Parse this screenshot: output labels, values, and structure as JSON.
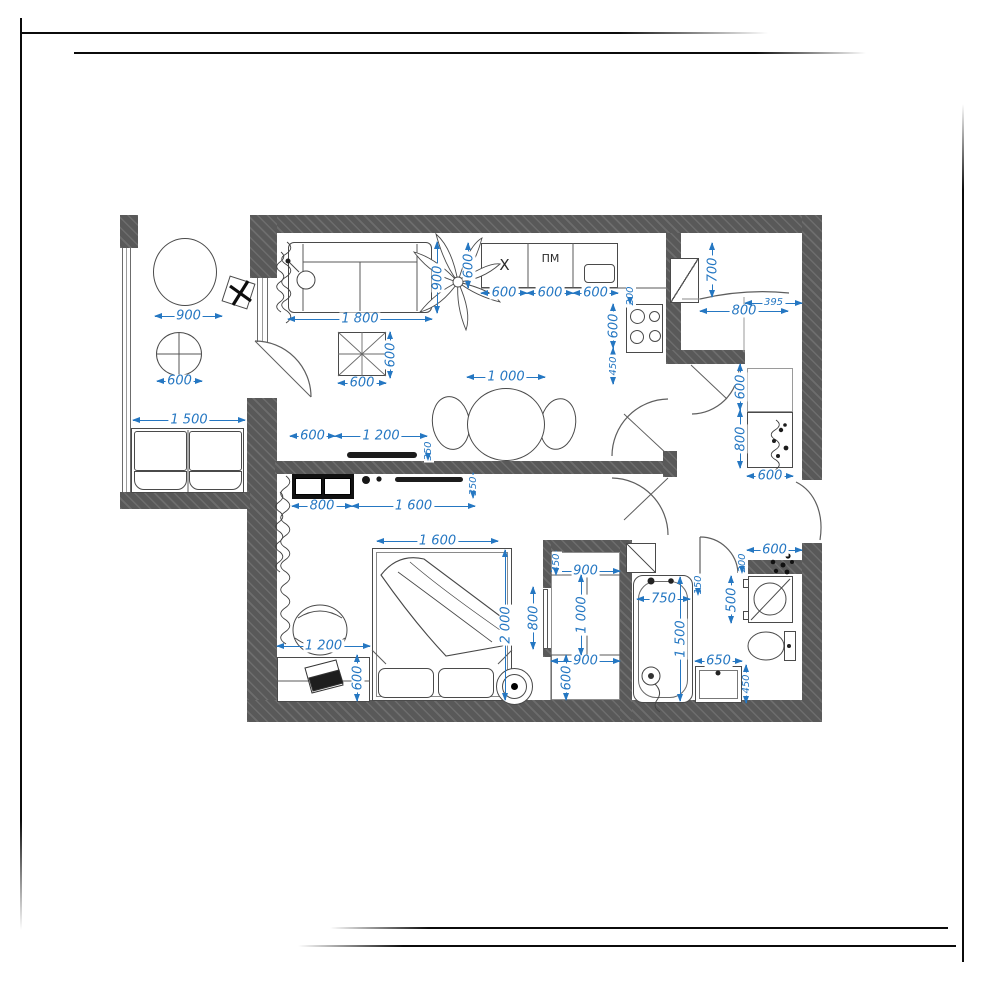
{
  "meta": {
    "kind": "apartment-floor-plan"
  },
  "colors": {
    "dimension_blue": "#2577c2",
    "wall_gray": "#595959"
  },
  "labels": {
    "sink_unit": "X",
    "dishwasher": "ПМ"
  },
  "dims": {
    "balcony_table_large": "900",
    "balcony_table_small": "600",
    "balcony_sofa": "1 500",
    "sofa_width": "1 800",
    "sofa_depth": "900",
    "counter_depth": "600",
    "coffee_table_w": "600",
    "coffee_table_h": "600",
    "counter_unit_1": "600",
    "counter_unit_2": "600",
    "counter_unit_3": "600",
    "counter_gap": "200",
    "stove_width": "600",
    "stove_offset": "450",
    "dining_table": "1 000",
    "entry_depth": "700",
    "entry_door": "800",
    "entry_niche": "395",
    "tv_offset": "600",
    "tv_width": "1 200",
    "tv_depth": "350",
    "tv2_depth": "350",
    "dresser_width": "800",
    "tv2_width": "1 600",
    "hall_opening": "600",
    "wardrobe_depth": "800",
    "wardrobe_width": "600",
    "bed_width": "1 600",
    "bed_length": "2 000",
    "desk_width": "1 200",
    "desk_depth": "600",
    "corridor_door": "800",
    "closet_top": "450",
    "closet_width_a": "900",
    "closet_height": "1 000",
    "closet_width_b": "900",
    "closet_bottom": "600",
    "bath_shelf_width": "600",
    "bath_shelf_gap": "200",
    "washer_width": "500",
    "tub_width": "750",
    "tub_length": "1 500",
    "tub_gap": "150",
    "vanity_width": "650",
    "vanity_depth": "450"
  }
}
